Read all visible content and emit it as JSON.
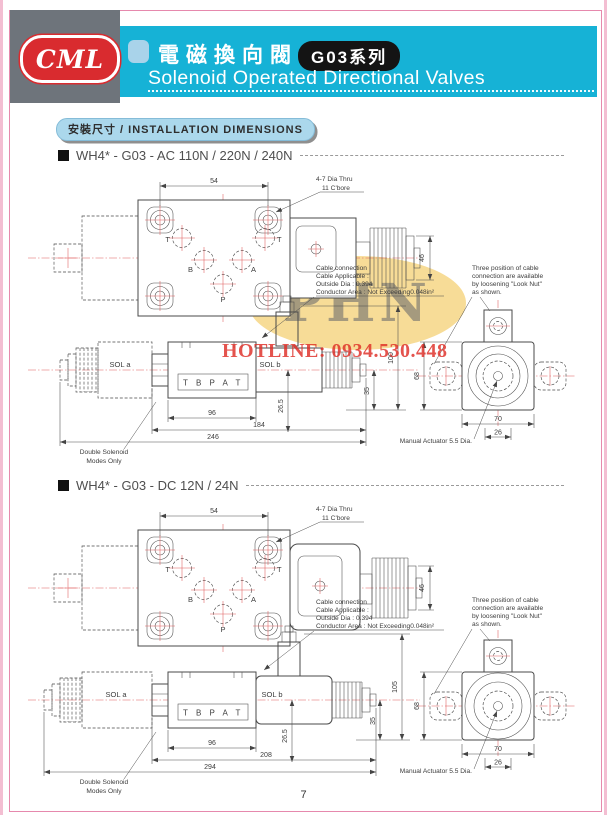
{
  "header": {
    "logo": "CML",
    "title_zh": "電磁換向閥",
    "series_badge": "G03系列",
    "subtitle_en": "Solenoid Operated Directional Valves",
    "accent_color": "#16b2d6"
  },
  "section_banner": "安裝尺寸 / INSTALLATION DIMENSIONS",
  "watermark": {
    "text": "PHN",
    "hotline": "HOTLINE: 0934.530.448"
  },
  "page_number": "7",
  "sections": [
    {
      "title": "WH4* - G03 - AC 110N / 220N / 240N",
      "hole_note": [
        "4-7 Dia Thru",
        "11 C'bore"
      ],
      "ports": {
        "t_left": "T",
        "b": "B",
        "a": "A",
        "p": "P",
        "t_right": "T"
      },
      "ports_box": "T B P A T",
      "sol_a": "SOL a",
      "sol_b": "SOL b",
      "cable_note": [
        "Cable connection",
        "Cable Applicable :",
        "Outside Dia : 0.394",
        "Conductor Area : Not Exceeding0.048in²"
      ],
      "three_position_note": [
        "Three position of cable",
        "connection are available",
        "by loosening \"Look Nut\"",
        "as shown."
      ],
      "manual_actuator": "Manual Actuator 5.5 Dia.",
      "double_solenoid": [
        "Double Solenoid",
        "Modes Only"
      ],
      "dims": {
        "bolt_pitch": "54",
        "coil_height": "46",
        "body_len": "96",
        "mid_len": "184",
        "overall_len": "246",
        "port_offset": "26.5",
        "base_height": "35",
        "total_height": "100",
        "end_height": "68",
        "end_width": "70",
        "actuator_pitch": "26"
      }
    },
    {
      "title": "WH4* - G03 - DC 12N / 24N",
      "hole_note": [
        "4-7 Dia Thru",
        "11 C'bore"
      ],
      "ports": {
        "t_left": "T",
        "b": "B",
        "a": "A",
        "p": "P",
        "t_right": "T"
      },
      "ports_box": "T B P A T",
      "sol_a": "SOL a",
      "sol_b": "SOL b",
      "cable_note": [
        "Cable connection",
        "Cable Applicable :",
        "Outside Dia : 0.394",
        "Conductor Area : Not Exceeding0.048in²"
      ],
      "three_position_note": [
        "Three position of cable",
        "connection are available",
        "by loosening \"Look Nut\"",
        "as shown."
      ],
      "manual_actuator": "Manual Actuator 5.5 Dia.",
      "double_solenoid": [
        "Double Solenoid",
        "Modes Only"
      ],
      "dims": {
        "bolt_pitch": "54",
        "coil_height": "46",
        "body_len": "96",
        "mid_len": "208",
        "overall_len": "294",
        "port_offset": "26.5",
        "base_height": "35",
        "total_height": "105",
        "end_height": "68",
        "end_width": "70",
        "actuator_pitch": "26"
      }
    }
  ]
}
